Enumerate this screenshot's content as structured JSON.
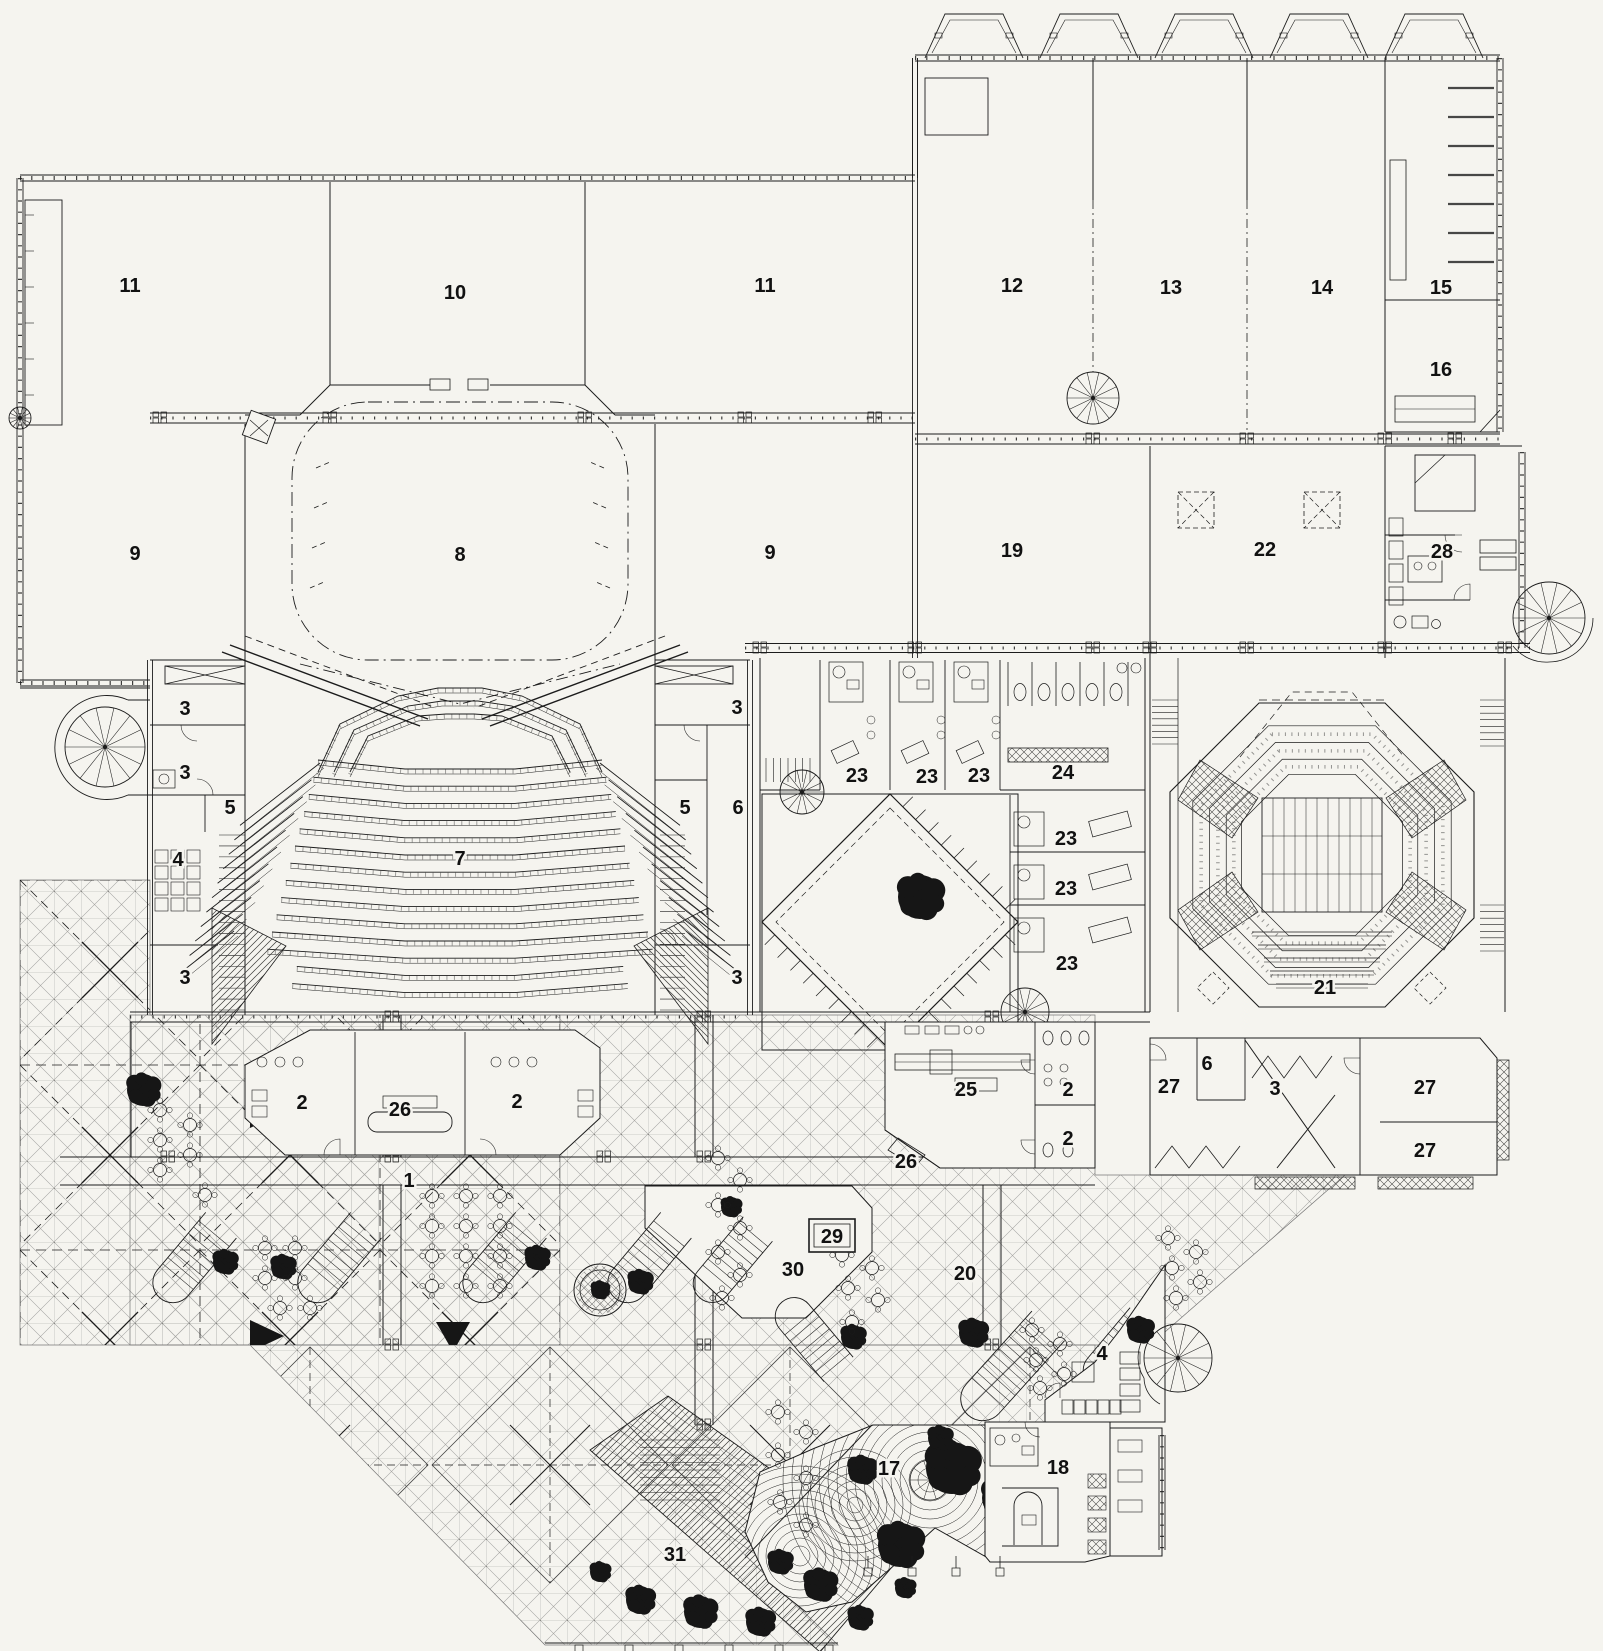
{
  "title": "floor-plan",
  "colors": {
    "paper": "#f5f4ef",
    "ink": "#1c1c1c",
    "grid": "#9a9a98",
    "vegetation": "#161616"
  },
  "rooms": [
    {
      "n": "11",
      "x": 130,
      "y": 285
    },
    {
      "n": "10",
      "x": 455,
      "y": 292
    },
    {
      "n": "11",
      "x": 765,
      "y": 285
    },
    {
      "n": "12",
      "x": 1012,
      "y": 285
    },
    {
      "n": "13",
      "x": 1171,
      "y": 287
    },
    {
      "n": "14",
      "x": 1322,
      "y": 287
    },
    {
      "n": "15",
      "x": 1441,
      "y": 287
    },
    {
      "n": "16",
      "x": 1441,
      "y": 369
    },
    {
      "n": "9",
      "x": 135,
      "y": 553
    },
    {
      "n": "8",
      "x": 460,
      "y": 554
    },
    {
      "n": "9",
      "x": 770,
      "y": 552
    },
    {
      "n": "19",
      "x": 1012,
      "y": 550
    },
    {
      "n": "22",
      "x": 1265,
      "y": 549
    },
    {
      "n": "28",
      "x": 1442,
      "y": 551
    },
    {
      "n": "3",
      "x": 185,
      "y": 708
    },
    {
      "n": "3",
      "x": 737,
      "y": 707
    },
    {
      "n": "3",
      "x": 185,
      "y": 772
    },
    {
      "n": "5",
      "x": 230,
      "y": 807
    },
    {
      "n": "7",
      "x": 460,
      "y": 858
    },
    {
      "n": "5",
      "x": 685,
      "y": 807
    },
    {
      "n": "6",
      "x": 738,
      "y": 807
    },
    {
      "n": "4",
      "x": 178,
      "y": 859
    },
    {
      "n": "3",
      "x": 185,
      "y": 977
    },
    {
      "n": "3",
      "x": 737,
      "y": 977
    },
    {
      "n": "23",
      "x": 857,
      "y": 775
    },
    {
      "n": "23",
      "x": 927,
      "y": 776
    },
    {
      "n": "23",
      "x": 979,
      "y": 775
    },
    {
      "n": "24",
      "x": 1063,
      "y": 772
    },
    {
      "n": "23",
      "x": 1066,
      "y": 838
    },
    {
      "n": "23",
      "x": 1066,
      "y": 888
    },
    {
      "n": "23",
      "x": 1067,
      "y": 963
    },
    {
      "n": "21",
      "x": 1325,
      "y": 987
    },
    {
      "n": "2",
      "x": 302,
      "y": 1102
    },
    {
      "n": "26",
      "x": 400,
      "y": 1109
    },
    {
      "n": "2",
      "x": 517,
      "y": 1101
    },
    {
      "n": "1",
      "x": 409,
      "y": 1180
    },
    {
      "n": "25",
      "x": 966,
      "y": 1089
    },
    {
      "n": "2",
      "x": 1068,
      "y": 1089
    },
    {
      "n": "2",
      "x": 1068,
      "y": 1138
    },
    {
      "n": "26",
      "x": 906,
      "y": 1161
    },
    {
      "n": "27",
      "x": 1169,
      "y": 1086
    },
    {
      "n": "6",
      "x": 1207,
      "y": 1063
    },
    {
      "n": "3",
      "x": 1275,
      "y": 1088
    },
    {
      "n": "27",
      "x": 1425,
      "y": 1087
    },
    {
      "n": "27",
      "x": 1425,
      "y": 1150
    },
    {
      "n": "30",
      "x": 793,
      "y": 1269
    },
    {
      "n": "20",
      "x": 965,
      "y": 1273
    },
    {
      "n": "4",
      "x": 1102,
      "y": 1353
    },
    {
      "n": "17",
      "x": 889,
      "y": 1468
    },
    {
      "n": "18",
      "x": 1058,
      "y": 1467
    },
    {
      "n": "31",
      "x": 675,
      "y": 1554
    }
  ],
  "boxed_room": {
    "n": "29",
    "x": 832,
    "y": 1236
  }
}
